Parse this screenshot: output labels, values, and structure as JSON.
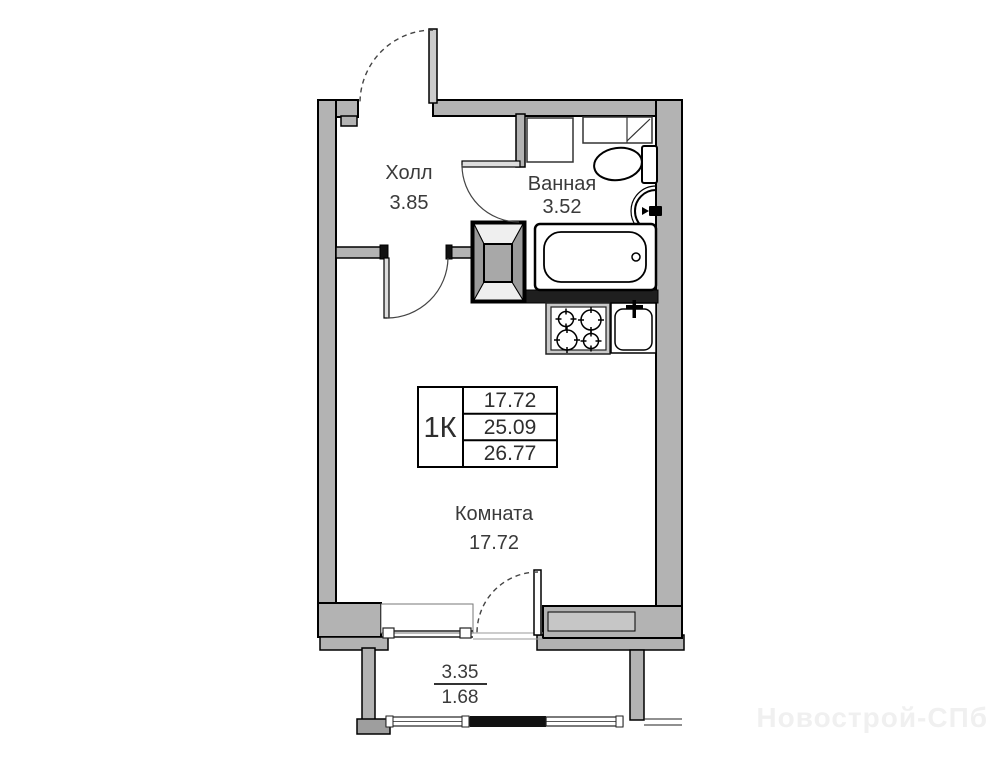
{
  "plan": {
    "rooms": [
      {
        "name_label": "Холл",
        "area_label": "3.85"
      },
      {
        "name_label": "Ванная",
        "area_label": "3.52"
      },
      {
        "name_label": "Комната",
        "area_label": "17.72"
      }
    ],
    "info_table": {
      "type_label": "1К",
      "rows": [
        "17.72",
        "25.09",
        "26.77"
      ]
    },
    "balcony": {
      "dim_top": "3.35",
      "dim_bottom": "1.68"
    },
    "watermark": "Новострой-СПб",
    "colors": {
      "wall_fill": "#b3b3b3",
      "wall_dark": "#1f1f1f",
      "line": "#000000",
      "watermark": "#f0f0f0",
      "background": "#ffffff"
    }
  }
}
